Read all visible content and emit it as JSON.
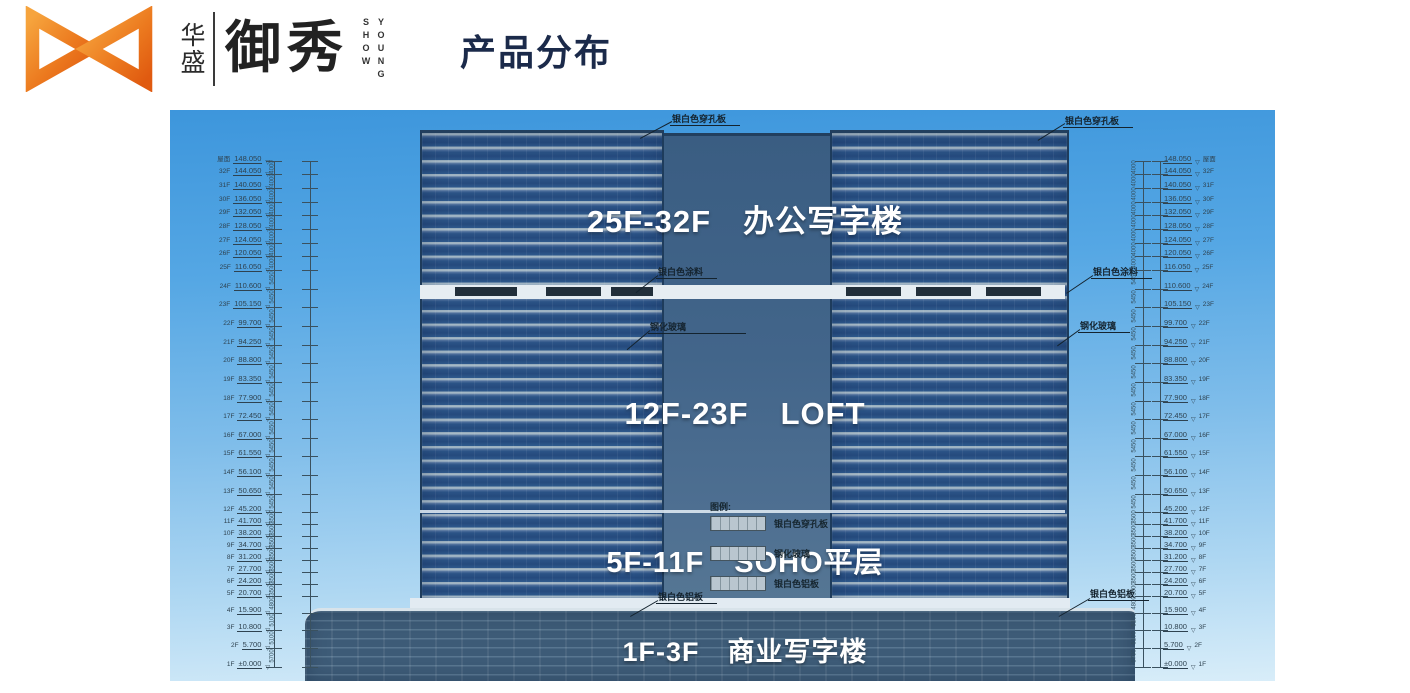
{
  "header": {
    "logo": {
      "brand_cn": "华盛",
      "brand_main": "御秀",
      "brand_en_col_left": "SHOW",
      "brand_en_col_right": "YOUNG"
    },
    "title": "产品分布"
  },
  "figure": {
    "zones": [
      {
        "label": "25F-32F　办公写字楼"
      },
      {
        "label": "12F-23F　LOFT"
      },
      {
        "label": "5F-11F　SOHO平层"
      },
      {
        "label": "1F-3F　商业写字楼"
      }
    ],
    "annotations": {
      "perf_left": "银白色穿孔板",
      "perf_right": "银白色穿孔板",
      "paint_left": "银白色涂料",
      "paint_right": "银白色涂料",
      "glass_left": "钢化玻璃",
      "glass_right": "钢化玻璃",
      "alum_left": "银白色铝板",
      "alum_right": "银白色铝板"
    },
    "legend": {
      "title": "图例:",
      "items": [
        {
          "label": "银白色穿孔板"
        },
        {
          "label": "钢化玻璃"
        },
        {
          "label": "银白色铝板"
        }
      ]
    },
    "floors": [
      {
        "elev": "148.050",
        "label": "屋面"
      },
      {
        "elev": "144.050",
        "label": "32F"
      },
      {
        "elev": "140.050",
        "label": "31F"
      },
      {
        "elev": "136.050",
        "label": "30F"
      },
      {
        "elev": "132.050",
        "label": "29F"
      },
      {
        "elev": "128.050",
        "label": "28F"
      },
      {
        "elev": "124.050",
        "label": "27F"
      },
      {
        "elev": "120.050",
        "label": "26F"
      },
      {
        "elev": "116.050",
        "label": "25F"
      },
      {
        "elev": "110.600",
        "label": "24F"
      },
      {
        "elev": "105.150",
        "label": "23F"
      },
      {
        "elev": "99.700",
        "label": "22F"
      },
      {
        "elev": "94.250",
        "label": "21F"
      },
      {
        "elev": "88.800",
        "label": "20F"
      },
      {
        "elev": "83.350",
        "label": "19F"
      },
      {
        "elev": "77.900",
        "label": "18F"
      },
      {
        "elev": "72.450",
        "label": "17F"
      },
      {
        "elev": "67.000",
        "label": "16F"
      },
      {
        "elev": "61.550",
        "label": "15F"
      },
      {
        "elev": "56.100",
        "label": "14F"
      },
      {
        "elev": "50.650",
        "label": "13F"
      },
      {
        "elev": "45.200",
        "label": "12F"
      },
      {
        "elev": "41.700",
        "label": "11F"
      },
      {
        "elev": "38.200",
        "label": "10F"
      },
      {
        "elev": "34.700",
        "label": "9F"
      },
      {
        "elev": "31.200",
        "label": "8F"
      },
      {
        "elev": "27.700",
        "label": "7F"
      },
      {
        "elev": "24.200",
        "label": "6F"
      },
      {
        "elev": "20.700",
        "label": "5F"
      },
      {
        "elev": "15.900",
        "label": "4F"
      },
      {
        "elev": "10.800",
        "label": "3F"
      },
      {
        "elev": "5.700",
        "label": "2F"
      },
      {
        "elev": "±0.000",
        "label": "1F"
      }
    ],
    "colors": {
      "sky_top": "#3d96dc",
      "sky_bottom": "#d8edf9",
      "facade_glass": "#2b5386",
      "core_wall": "#3f6286",
      "annotation_text": "#14232e",
      "logo_orange": "#e8641a",
      "title_navy": "#1b2a4a"
    }
  }
}
